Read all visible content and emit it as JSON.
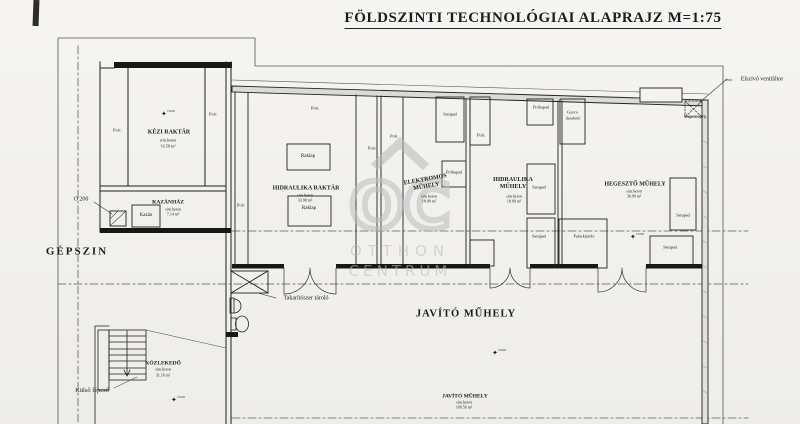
{
  "title": "FÖLDSZINTI TECHNOLÓGIAI ALAPRAJZ  M=1:75",
  "watermark": {
    "logo": "OC",
    "line1": "OTTHON",
    "line2": "CENTRUM"
  },
  "annotations": {
    "elszivo": "Elszívó ventilátor",
    "gepszin": "GÉPSZIN",
    "o200": "O 200",
    "kulso_lepcso": "Külső lépcső",
    "takaritoszer": "Takarítószer tároló",
    "level": "±0.00"
  },
  "rooms": {
    "kezi_raktar": {
      "name": "KÉZI RAKTÁR",
      "floor": "sim.beton",
      "area": "16.58 m²"
    },
    "kazanhaz": {
      "name": "KAZÁNHÁZ",
      "floor": "sim.beton",
      "area": "7.14 m²"
    },
    "hidraulika_raktar": {
      "name": "HIDRAULIKA RAKTÁR",
      "floor": "sim.beton",
      "area": "33.90 m²"
    },
    "elektromos_muhely": {
      "name": "ELEKTROMOS MŰHELY",
      "floor": "sim.beton",
      "area": "18.00 m²"
    },
    "hidraulika_muhely": {
      "name": "HIDRAULIKA MŰHELY",
      "floor": "sim.beton",
      "area": "18.00 m²"
    },
    "hegeszto_muhely": {
      "name": "HEGESZTŐ MŰHELY",
      "floor": "sim.beton",
      "area": "30.90 m²"
    },
    "javito_muhely": {
      "name": "JAVÍTÓ MŰHELY",
      "floor": "sim.beton",
      "area": "160.56 m²"
    },
    "kozlekedo": {
      "name": "KÖZLEKEDŐ",
      "floor": "sim.beton",
      "area": "31.16 m²"
    }
  },
  "furniture": {
    "polc": "Polc",
    "satupad": "Satupad",
    "raklap": "Raklap",
    "kazan": "Kazán",
    "probapad": "Próbapad",
    "gyors1": "Gyors-",
    "gyors2": "daraboló",
    "palacktarolo": "Palacktároló",
    "hegesztogep": "Hegesztőgép"
  },
  "colors": {
    "ink": "#1f1f1f",
    "paper": "#f2f1ee",
    "watermark": "#bdbdbd"
  }
}
